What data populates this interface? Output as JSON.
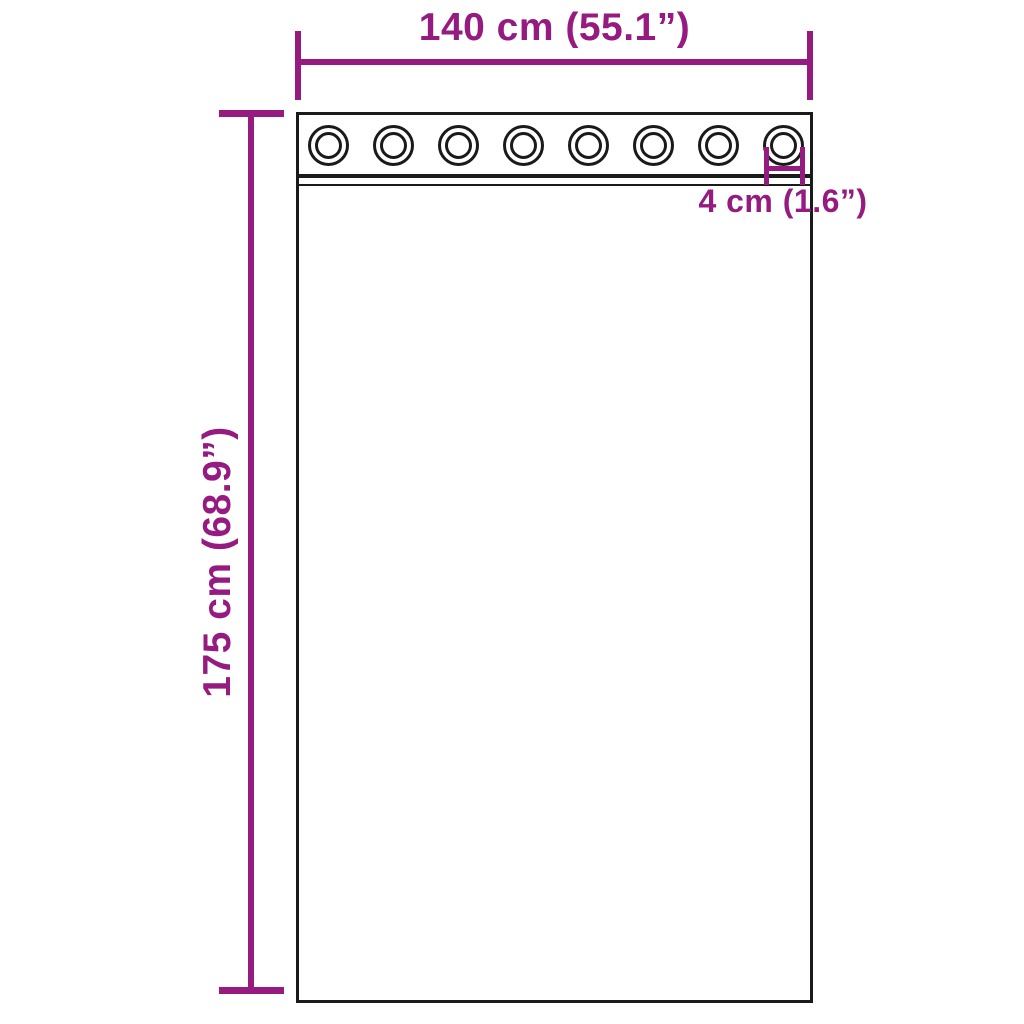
{
  "colors": {
    "accent": "#951b81",
    "outline": "#1a1a1a",
    "background": "#ffffff"
  },
  "dimensions": {
    "width_label": "140 cm (55.1”)",
    "height_label": "175 cm (68.9”)",
    "grommet_diameter_label": "4 cm (1.6”)"
  },
  "curtain": {
    "grommet_count": 8
  }
}
